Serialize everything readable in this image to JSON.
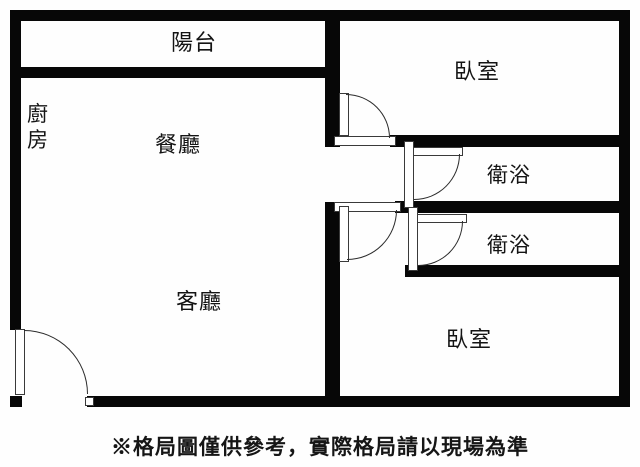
{
  "floorplan": {
    "rooms": [
      {
        "id": "balcony",
        "label": "陽台"
      },
      {
        "id": "kitchen",
        "label": "廚房"
      },
      {
        "id": "dining",
        "label": "餐廳"
      },
      {
        "id": "bedroom-top",
        "label": "臥室"
      },
      {
        "id": "bath-upper",
        "label": "衛浴"
      },
      {
        "id": "bath-lower",
        "label": "衛浴"
      },
      {
        "id": "living",
        "label": "客廳"
      },
      {
        "id": "bedroom-bottom",
        "label": "臥室"
      }
    ],
    "disclaimer": "※格局圖僅供參考，實際格局請以現場為準",
    "colors": {
      "wall": "#070707",
      "background": "#ffffff",
      "text": "#141414"
    }
  }
}
